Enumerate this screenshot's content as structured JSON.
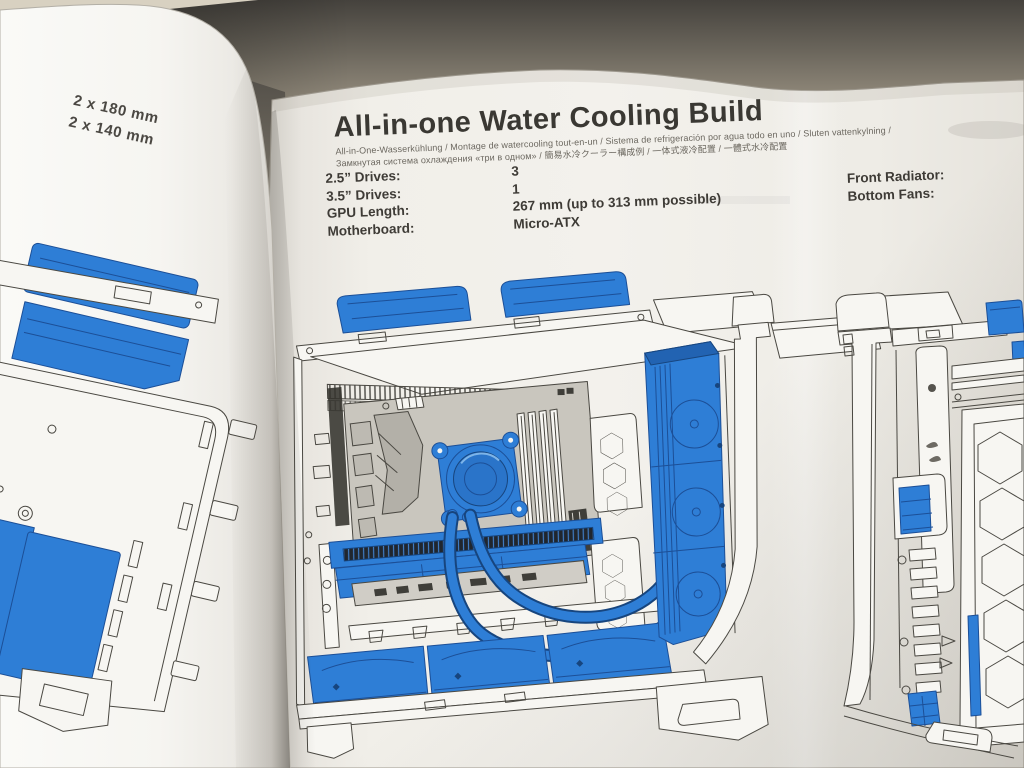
{
  "colors": {
    "highlight_blue": "#2e7ed6",
    "highlight_blue_dark": "#1c4f97",
    "ink": "#45433e",
    "paper_main": "#f1efe9",
    "paper_left": "#f6f5f1",
    "motherboard_gray": "#c9c6be",
    "background_dark": "#45423d",
    "background_tan": "#b0a898"
  },
  "left_page": {
    "note_line1": "2 x 180 mm",
    "note_line2": "2 x 140 mm"
  },
  "main_page": {
    "title": "All-in-one Water Cooling Build",
    "subtitle_line1": "All-in-One-Wasserkühlung / Montage de watercooling tout-en-un / Sistema de refrigeración por agua todo en uno / Sluten vattenkylning /",
    "subtitle_line2": "Замкнутая система охлаждения «три в одном» / 簡易水冷クーラー構成例 / 一体式液冷配置 / 一體式水冷配置",
    "specs": {
      "rows": [
        {
          "label": "2.5” Drives:",
          "value": "3"
        },
        {
          "label": "3.5” Drives:",
          "value": "1"
        },
        {
          "label": "GPU Length:",
          "value": "267 mm (up to 313 mm possible)"
        },
        {
          "label": "Motherboard:",
          "value": "Micro-ATX"
        }
      ]
    },
    "right_specs": {
      "rows": [
        {
          "label": "Front Radiator:"
        },
        {
          "label": "Bottom Fans:"
        }
      ]
    }
  },
  "figures": {
    "left": "case-rear-quarter-line-art",
    "center": "case-interior-aio-watercooling-line-art",
    "right": "case-front-quarter-line-art"
  }
}
